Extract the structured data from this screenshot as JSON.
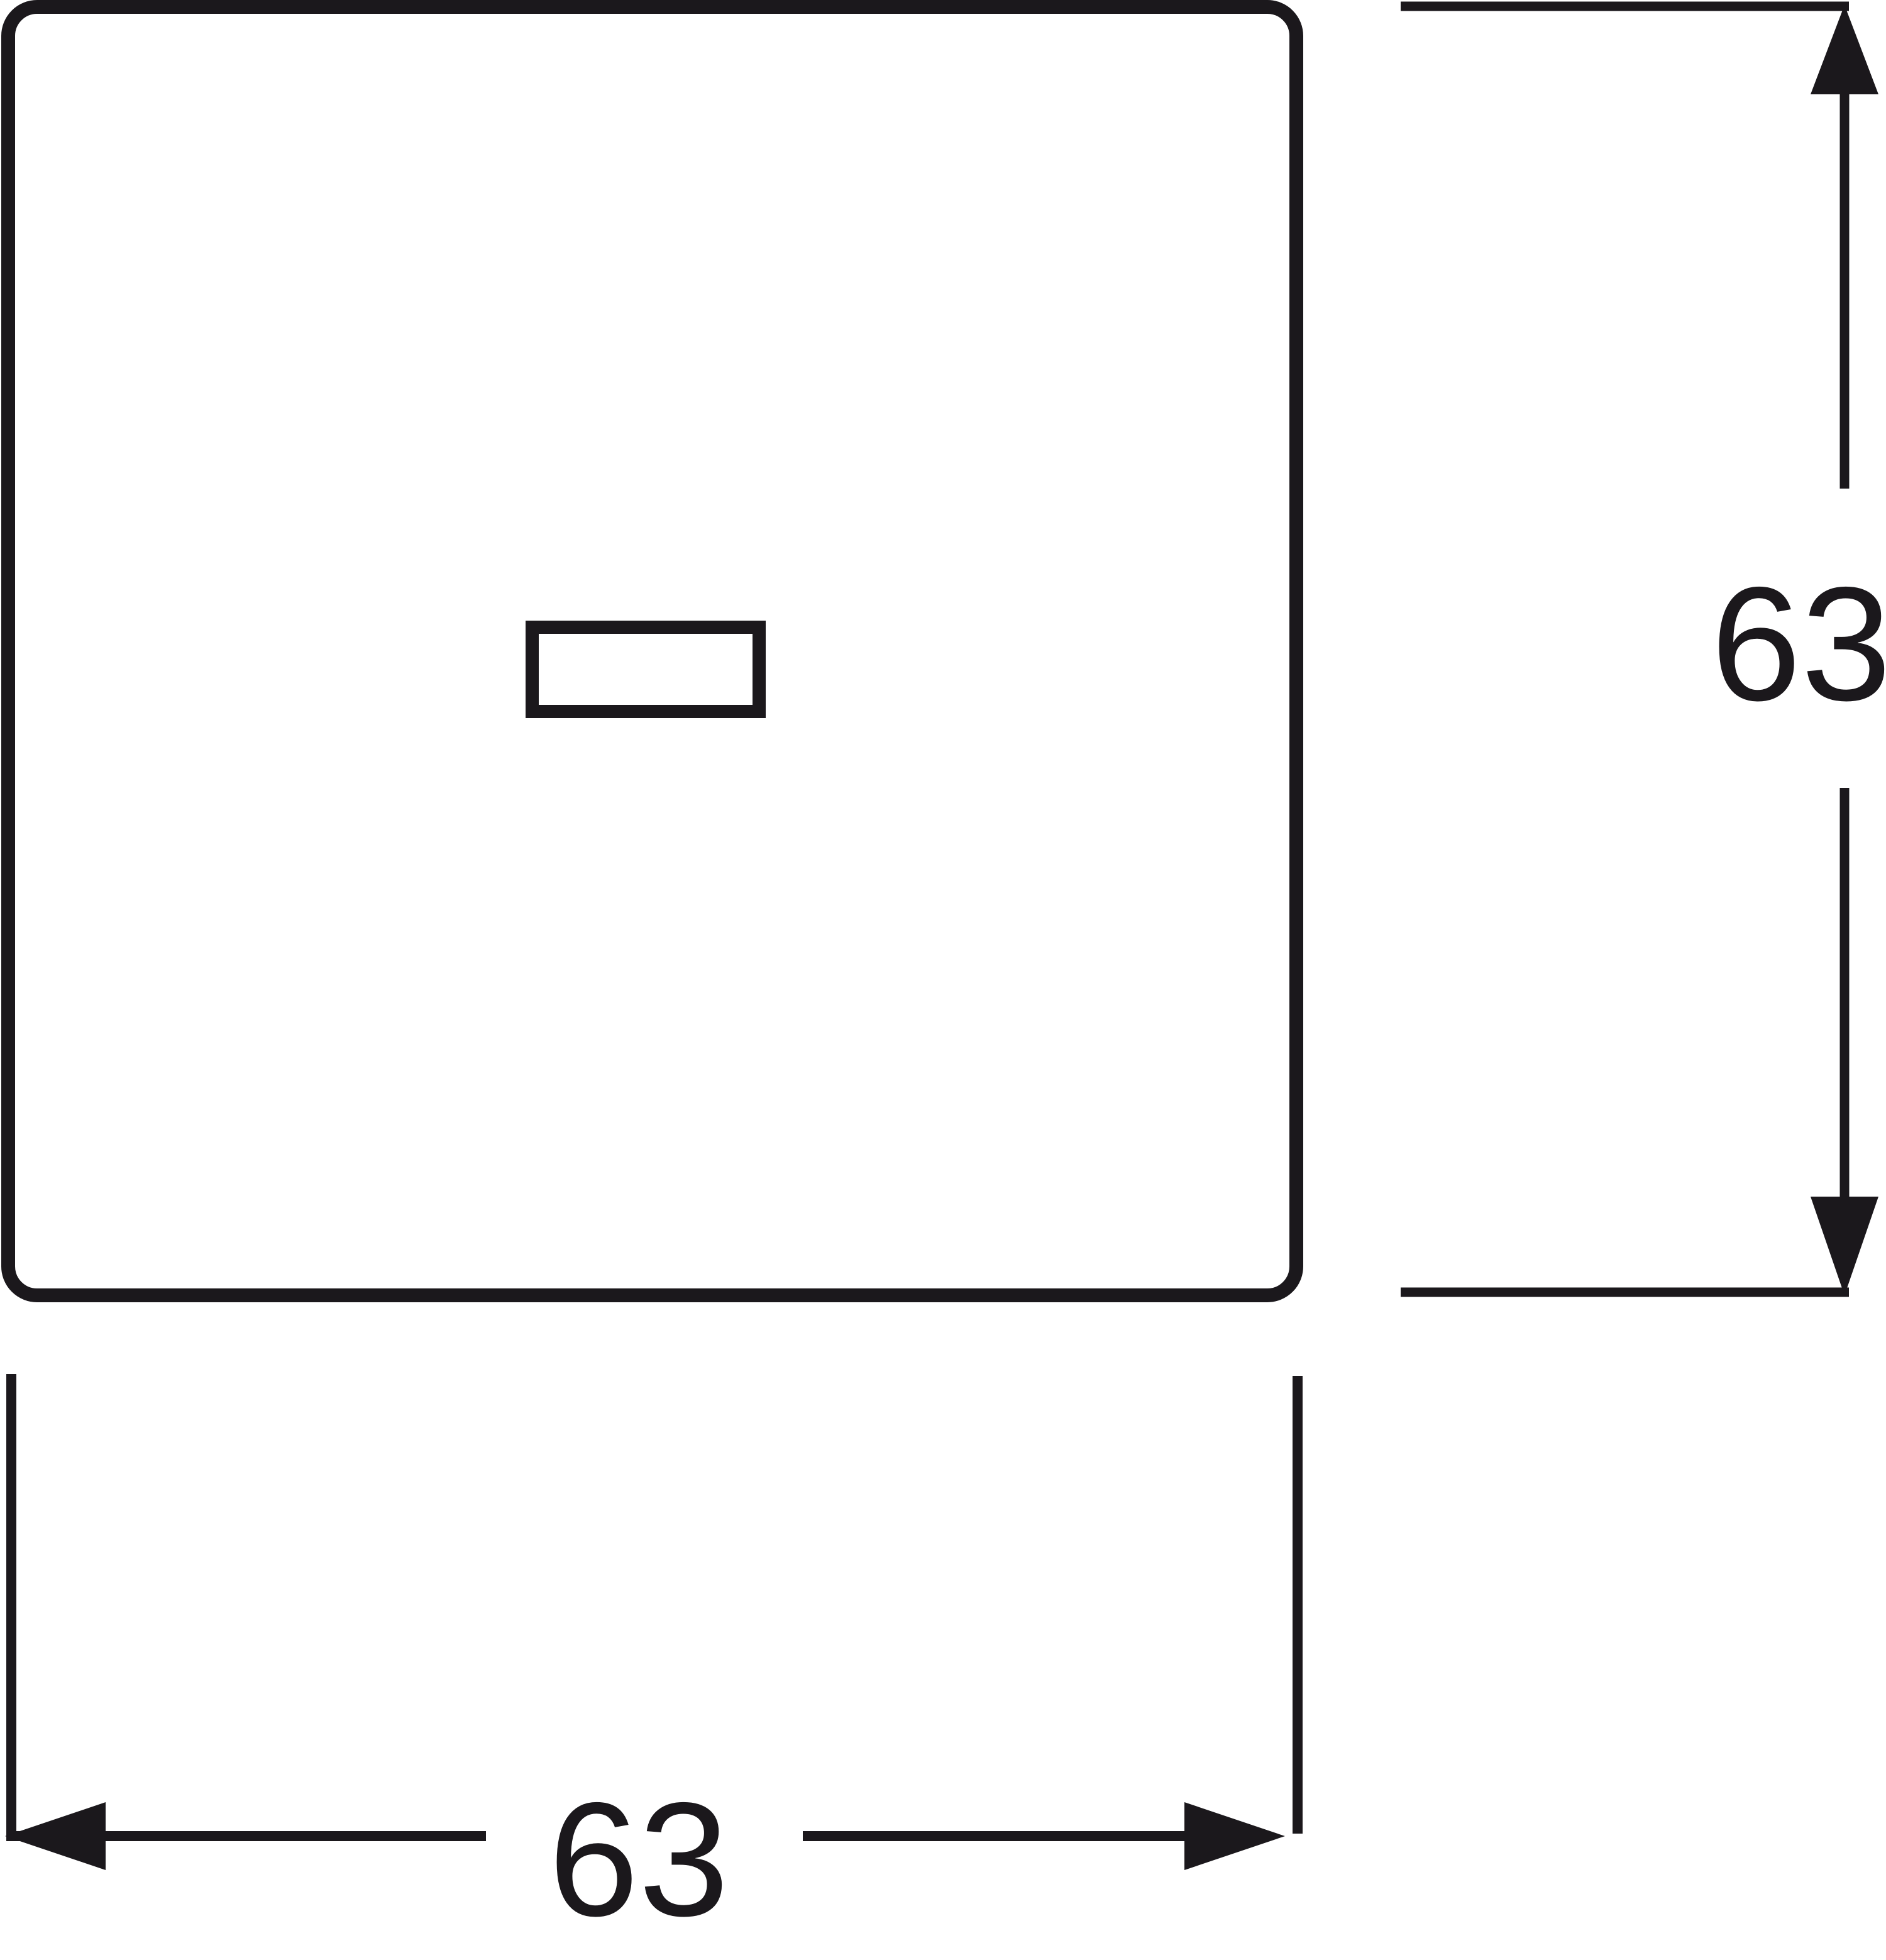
{
  "drawing": {
    "ink_color": "#1b181c",
    "background_color": "#ffffff",
    "height_dimension": {
      "label": "63"
    },
    "width_dimension": {
      "label": "63"
    }
  }
}
